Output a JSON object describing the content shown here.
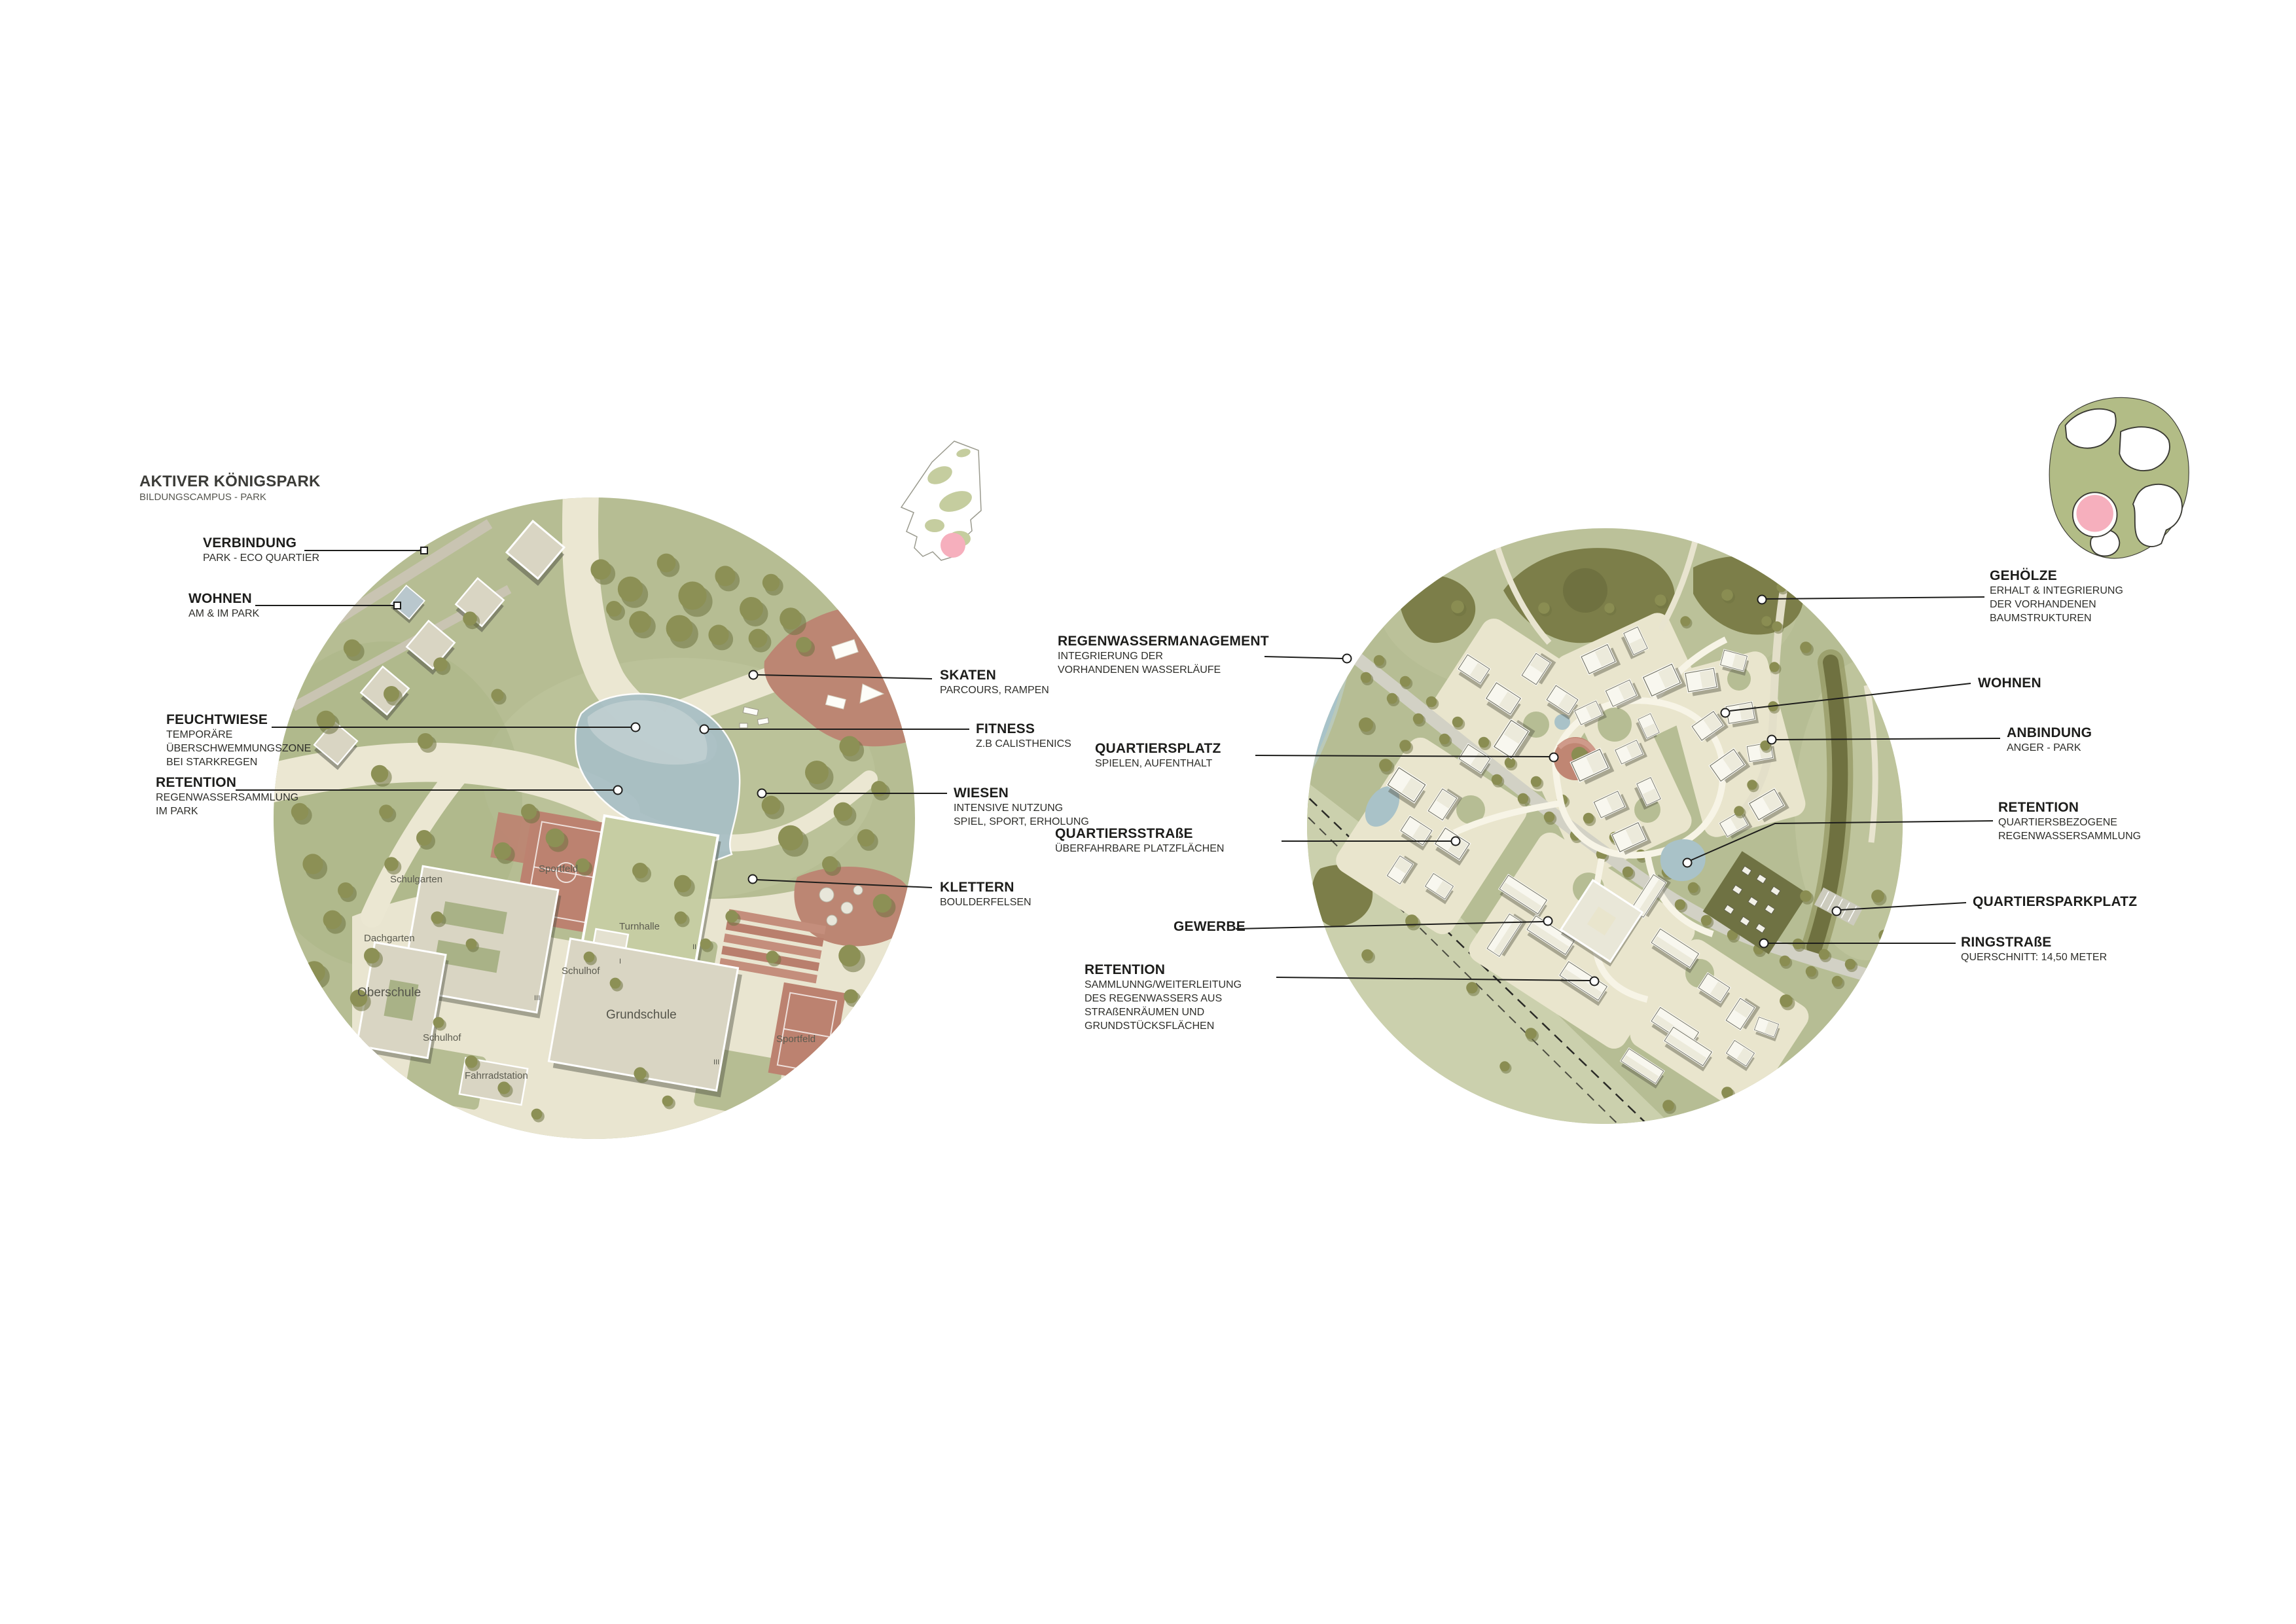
{
  "title": {
    "main": "AKTIVER KÖNIGSPARK",
    "sub": "BILDUNGSCAMPUS - PARK"
  },
  "labels": {
    "verbindung": {
      "head": "VERBINDUNG",
      "sub1": "PARK - ECO QUARTIER"
    },
    "wohnen_park": {
      "head": "WOHNEN",
      "sub1": "AM & IM PARK"
    },
    "feuchtwiese": {
      "head": "FEUCHTWIESE",
      "sub1": "TEMPORÄRE",
      "sub2": "ÜBERSCHWEMMUNGSZONE",
      "sub3": "BEI STARKREGEN"
    },
    "retention_park": {
      "head": "RETENTION",
      "sub1": "REGENWASSERSAMMLUNG",
      "sub2": "IM PARK"
    },
    "skaten": {
      "head": "SKATEN",
      "sub1": "PARCOURS, RAMPEN"
    },
    "fitness": {
      "head": "FITNESS",
      "sub1": "Z.B CALISTHENICS"
    },
    "wiesen": {
      "head": "WIESEN",
      "sub1": "INTENSIVE NUTZUNG",
      "sub2": "SPIEL, SPORT, ERHOLUNG"
    },
    "klettern": {
      "head": "KLETTERN",
      "sub1": "BOULDERFELSEN"
    },
    "regenwassermanagement": {
      "head": "REGENWASSERMANAGEMENT",
      "sub1": "INTEGRIERUNG DER",
      "sub2": "VORHANDENEN WASSERLÄUFE"
    },
    "quartiersplatz": {
      "head": "QUARTIERSPLATZ",
      "sub1": "SPIELEN, AUFENTHALT"
    },
    "quartiersstrasse": {
      "head": "QUARTIERSSTRAßE",
      "sub1": "ÜBERFAHRBARE PLATZFLÄCHEN"
    },
    "gewerbe": {
      "head": "GEWERBE"
    },
    "retention_strasse": {
      "head": "RETENTION",
      "sub1": "SAMMLUNNG/WEITERLEITUNG",
      "sub2": "DES REGENWASSERS AUS",
      "sub3": "STRAßENRÄUMEN UND",
      "sub4": "GRUNDSTÜCKSFLÄCHEN"
    },
    "gehoelze": {
      "head": "GEHÖLZE",
      "sub1": "ERHALT & INTEGRIERUNG",
      "sub2": "DER VORHANDENEN",
      "sub3": "BAUMSTRUKTUREN"
    },
    "wohnen_quartier": {
      "head": "WOHNEN"
    },
    "anbindung": {
      "head": "ANBINDUNG",
      "sub1": "ANGER - PARK"
    },
    "retention_quartier": {
      "head": "RETENTION",
      "sub1": "QUARTIERSBEZOGENE",
      "sub2": "REGENWASSERSAMMLUNG"
    },
    "quartiersparkplatz": {
      "head": "QUARTIERSPARKPLATZ"
    },
    "ringstrasse": {
      "head": "RINGSTRAßE",
      "sub1": "QUERSCHNITT: 14,50 METER"
    }
  },
  "map_labels": {
    "schulgarten": "Schulgarten",
    "sportfeld_nord": "Sportfeld",
    "dachgarten": "Dachgarten",
    "oberschule": "Oberschule",
    "turnhalle": "Turnhalle",
    "schulhof_west": "Schulhof",
    "schulhof_ost": "Schulhof",
    "grundschule": "Grundschule",
    "sportfeld_ost": "Sportfeld",
    "fahrradstation": "Fahrradstation",
    "floors_oberschule": "III",
    "floors_turnhalle": "II",
    "floors_annex": "I",
    "floors_grundschule": "III"
  },
  "colors": {
    "park_green": "#b6bd93",
    "forest_green": "#7c7e49",
    "path_cream": "#e9e5d0",
    "water_blue": "#a9bfc5",
    "field_red": "#bc8673",
    "building_beige": "#d9d5c3",
    "building_white": "#f4f3ea",
    "marker_pink": "#f6afbd",
    "leader_black": "#1d1d1b"
  }
}
